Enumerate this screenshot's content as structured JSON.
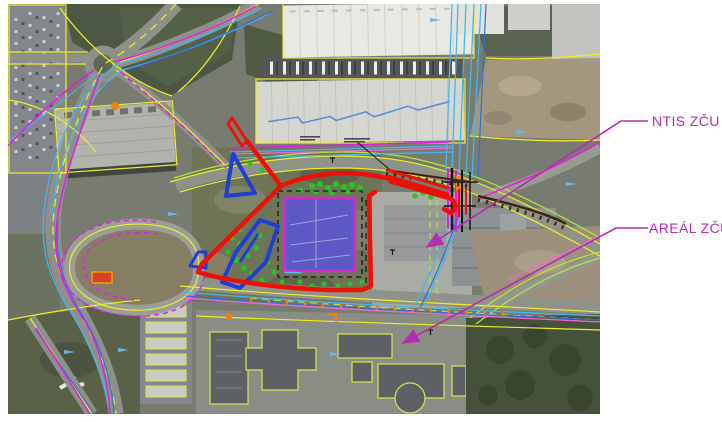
{
  "figure": {
    "type": "annotated-aerial-site-map",
    "description": "Aerial orthophoto with CAD utility overlay, red route outline, blue object outlines and violet development site"
  },
  "labels": {
    "ntis": {
      "text": "NTIS ZČU"
    },
    "areal": {
      "text": "AREÁL ZČU"
    }
  },
  "colors": {
    "annotation": "#b52cae",
    "route_red": "#ee1005",
    "site_fill": "#5b55d2",
    "site_border": "#e020e0",
    "object_blue": "#1f3fd4",
    "greenery": "#1fc91f",
    "cadastre_yellow": "#eeee28",
    "utility_cyan": "#49b5e9",
    "utility_magenta": "#e818e8",
    "page_background": "#ffffff"
  }
}
